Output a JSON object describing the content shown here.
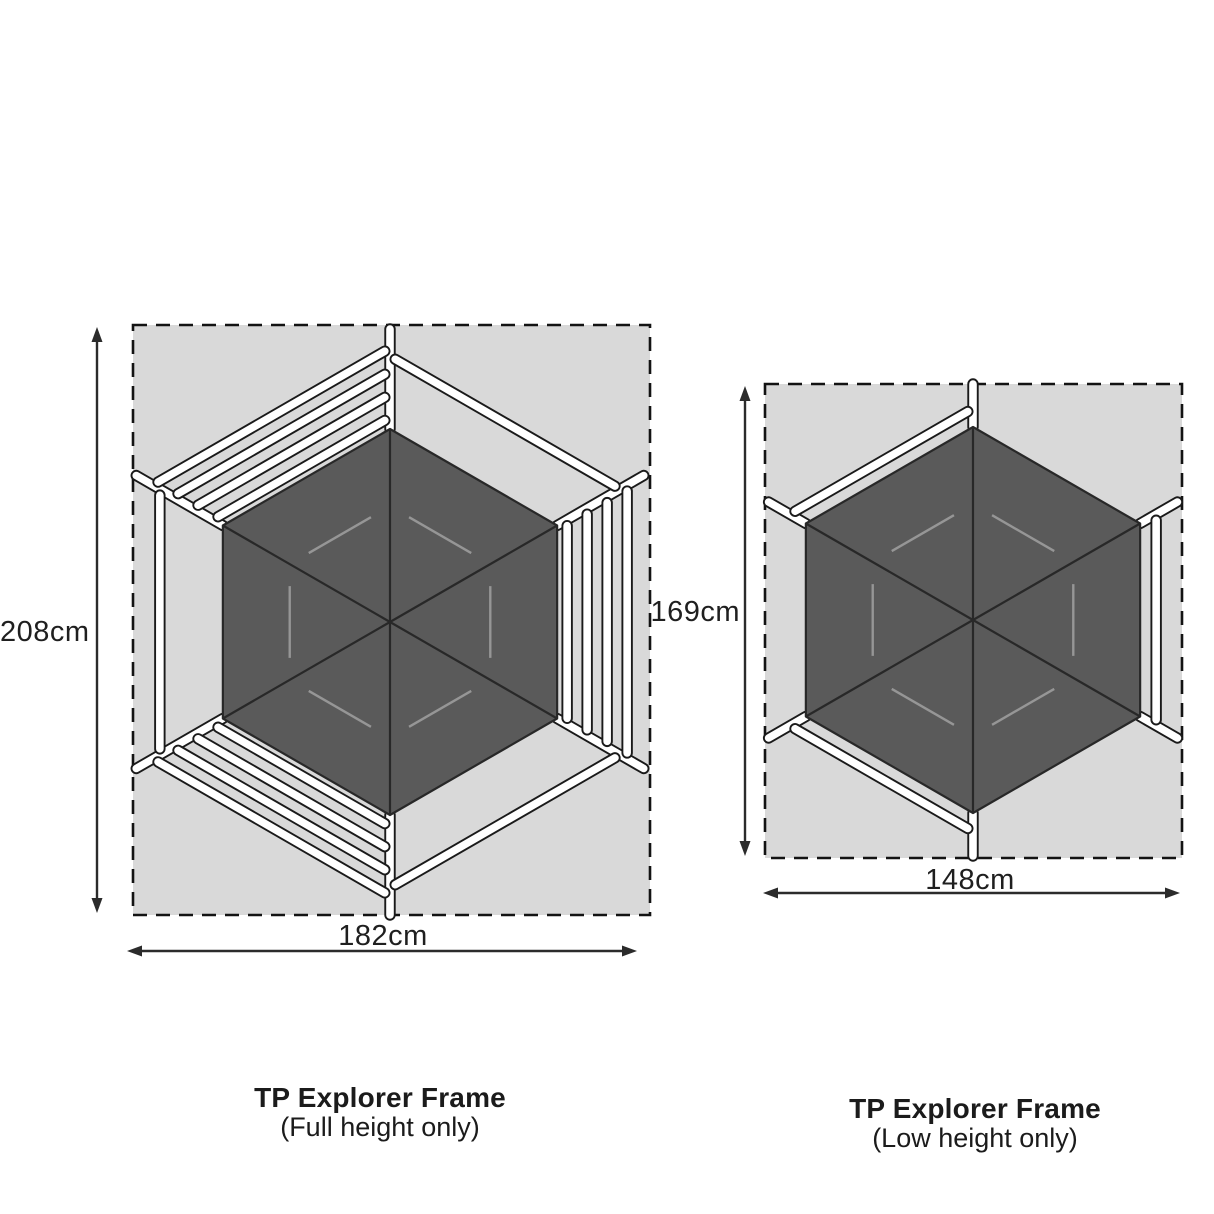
{
  "colors": {
    "area_fill": "#d9d9d9",
    "border": "#131313",
    "hex_fill": "#5a5a5a",
    "hex_line": "#282828",
    "inner_line": "#969696",
    "tube_fill": "#ffffff",
    "tube_outline": "#1a1a1a",
    "arrow": "#2b2b2b",
    "text": "#1f1f1f"
  },
  "diagrams": [
    {
      "name": "TP Explorer Frame footprint (full height)",
      "height_label": "208cm",
      "width_label": "182cm",
      "caption_title": "TP Explorer Frame",
      "caption_sub": "(Full height only)",
      "rect": {
        "x": 133,
        "y": 325,
        "w": 517,
        "h": 590
      },
      "hex": {
        "cx": 390,
        "cy": 622,
        "r": 193
      },
      "inner_scale": 0.6,
      "inner_trim": 0.19,
      "stub_len": 100,
      "multi_offsets": [
        10,
        30,
        50,
        70
      ],
      "single_offset": 63,
      "faces": {
        "top_left": 4,
        "bottom_left": 4,
        "right": 4,
        "left": 1,
        "top_right": 1,
        "bottom_right": 1
      },
      "v_arrow": {
        "x": 97,
        "y1": 327,
        "y2": 913
      },
      "h_arrow": {
        "y": 951,
        "x1": 127,
        "x2": 637
      }
    },
    {
      "name": "TP Explorer Frame footprint (low height)",
      "height_label": "169cm",
      "width_label": "148cm",
      "caption_title": "TP Explorer Frame",
      "caption_sub": "(Low height only)",
      "rect": {
        "x": 765,
        "y": 384,
        "w": 417,
        "h": 474
      },
      "hex": {
        "cx": 973,
        "cy": 620,
        "r": 193
      },
      "inner_scale": 0.6,
      "inner_trim": 0.19,
      "stub_len": 43,
      "multi_offsets": [
        16
      ],
      "single_offset": 16,
      "faces": {
        "top_left": 1,
        "bottom_left": 1,
        "right": 1,
        "left": 0,
        "top_right": 0,
        "bottom_right": 0
      },
      "v_arrow": {
        "x": 745,
        "y1": 386,
        "y2": 856
      },
      "h_arrow": {
        "y": 893,
        "x1": 763,
        "x2": 1180
      }
    }
  ]
}
